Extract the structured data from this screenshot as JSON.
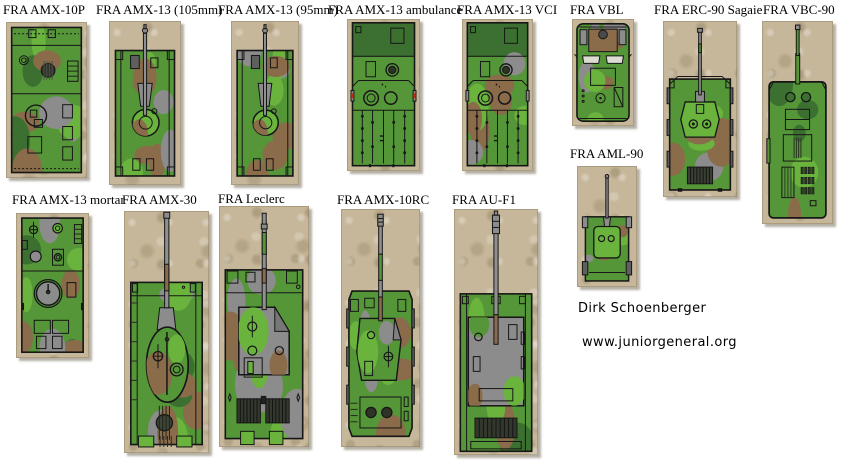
{
  "page": {
    "width": 863,
    "height": 472,
    "background": "#ffffff"
  },
  "palette": {
    "tan": "#c6b79a",
    "tan_dark": "#ac9c7e",
    "tan_light": "#d9cdb0",
    "green": "#559738",
    "green_bright": "#6ab43e",
    "green_dark": "#3c7030",
    "brown": "#8a6b4a",
    "gray": "#8c8c8c",
    "gray_dark": "#5f5f5f",
    "outline": "#161616",
    "barrel": "#909090",
    "red": "#cc2a1e",
    "white": "#dcdcd2"
  },
  "credits": {
    "author": "Dirk Schoenberger",
    "website": "www.juniorgeneral.org"
  },
  "vehicles": [
    {
      "id": "amx-10p",
      "label": "FRA AMX-10P",
      "kind": "apc",
      "seed": 3,
      "label_pos": {
        "x": 3,
        "y": 3
      },
      "tile": {
        "x": 6,
        "y": 22,
        "w": 81,
        "h": 156
      }
    },
    {
      "id": "amx-13-105",
      "label": "FRA AMX-13 (105mm)",
      "kind": "lighttank",
      "seed": 7,
      "label_pos": {
        "x": 96,
        "y": 3
      },
      "tile": {
        "x": 109,
        "y": 21,
        "w": 72,
        "h": 164
      }
    },
    {
      "id": "amx-13-95",
      "label": "FRA AMX-13 (95mm)",
      "kind": "lighttank",
      "seed": 11,
      "label_pos": {
        "x": 218,
        "y": 3
      },
      "tile": {
        "x": 231,
        "y": 21,
        "w": 68,
        "h": 164
      }
    },
    {
      "id": "amx-13-ambulance",
      "label": "FRA AMX-13 ambulance",
      "kind": "ambulance",
      "seed": 5,
      "label_pos": {
        "x": 328,
        "y": 3
      },
      "tile": {
        "x": 347,
        "y": 19,
        "w": 73,
        "h": 152
      }
    },
    {
      "id": "amx-13-vci",
      "label": "FRA AMX-13 VCI",
      "kind": "vci",
      "seed": 9,
      "label_pos": {
        "x": 457,
        "y": 3
      },
      "tile": {
        "x": 462,
        "y": 19,
        "w": 71,
        "h": 152
      }
    },
    {
      "id": "vbl",
      "label": "FRA VBL",
      "kind": "vbl",
      "seed": 13,
      "label_pos": {
        "x": 570,
        "y": 3
      },
      "tile": {
        "x": 572,
        "y": 19,
        "w": 62,
        "h": 107
      }
    },
    {
      "id": "erc-90",
      "label": "FRA ERC-90 Sagaie",
      "kind": "erc90",
      "seed": 17,
      "label_pos": {
        "x": 654,
        "y": 3
      },
      "tile": {
        "x": 663,
        "y": 21,
        "w": 74,
        "h": 176
      }
    },
    {
      "id": "vbc-90",
      "label": "FRA VBC-90",
      "kind": "vbc90",
      "seed": 19,
      "label_pos": {
        "x": 763,
        "y": 3
      },
      "tile": {
        "x": 762,
        "y": 21,
        "w": 71,
        "h": 203
      }
    },
    {
      "id": "aml-90",
      "label": "FRA AML-90",
      "kind": "aml90",
      "seed": 23,
      "label_pos": {
        "x": 570,
        "y": 147
      },
      "tile": {
        "x": 577,
        "y": 166,
        "w": 60,
        "h": 121
      }
    },
    {
      "id": "amx-13-mortar",
      "label": "FRA AMX-13 mortar",
      "kind": "mortar",
      "seed": 29,
      "label_pos": {
        "x": 12,
        "y": 193
      },
      "tile": {
        "x": 16,
        "y": 213,
        "w": 73,
        "h": 145
      }
    },
    {
      "id": "amx-30",
      "label": "FRA AMX-30",
      "kind": "amx30",
      "seed": 31,
      "label_pos": {
        "x": 122,
        "y": 193
      },
      "tile": {
        "x": 124,
        "y": 211,
        "w": 85,
        "h": 242
      }
    },
    {
      "id": "leclerc",
      "label": "FRA Leclerc",
      "kind": "leclerc",
      "seed": 37,
      "label_pos": {
        "x": 218,
        "y": 192
      },
      "tile": {
        "x": 219,
        "y": 206,
        "w": 90,
        "h": 241
      }
    },
    {
      "id": "amx-10rc",
      "label": "FRA AMX-10RC",
      "kind": "amx10rc",
      "seed": 41,
      "label_pos": {
        "x": 337,
        "y": 193
      },
      "tile": {
        "x": 341,
        "y": 209,
        "w": 79,
        "h": 238
      }
    },
    {
      "id": "au-f1",
      "label": "FRA AU-F1",
      "kind": "auf1",
      "seed": 43,
      "label_pos": {
        "x": 452,
        "y": 193
      },
      "tile": {
        "x": 454,
        "y": 209,
        "w": 84,
        "h": 246
      }
    }
  ]
}
